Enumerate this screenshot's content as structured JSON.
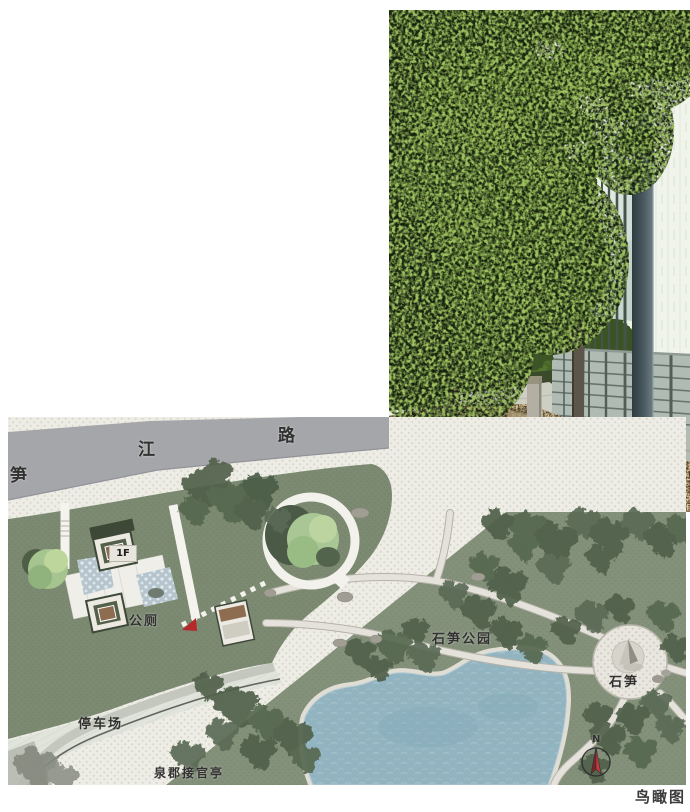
{
  "caption": "鸟瞰图",
  "plan": {
    "road_name_chars": [
      "笋",
      "江",
      "路"
    ],
    "building_floor_label": "1F",
    "toilet_label": "公厕",
    "parking_label": "停车场",
    "pavilion_label": "泉郡接官亭",
    "park_label": "石笋公园",
    "stone_label": "石笋",
    "compass_north_label": "N"
  },
  "colors": {
    "road": "#a5a6aa",
    "paving": "#edece5",
    "lawn_green": "#7c8a72",
    "park_green": "#83907a",
    "pond_blue": "#92b4c1",
    "tree_dark": "#5a6a54",
    "tree_light": "#a9c795",
    "roof_brown": "#8d6c50",
    "entrance_marker_red": "#b5282c",
    "label_text": "#313131"
  }
}
